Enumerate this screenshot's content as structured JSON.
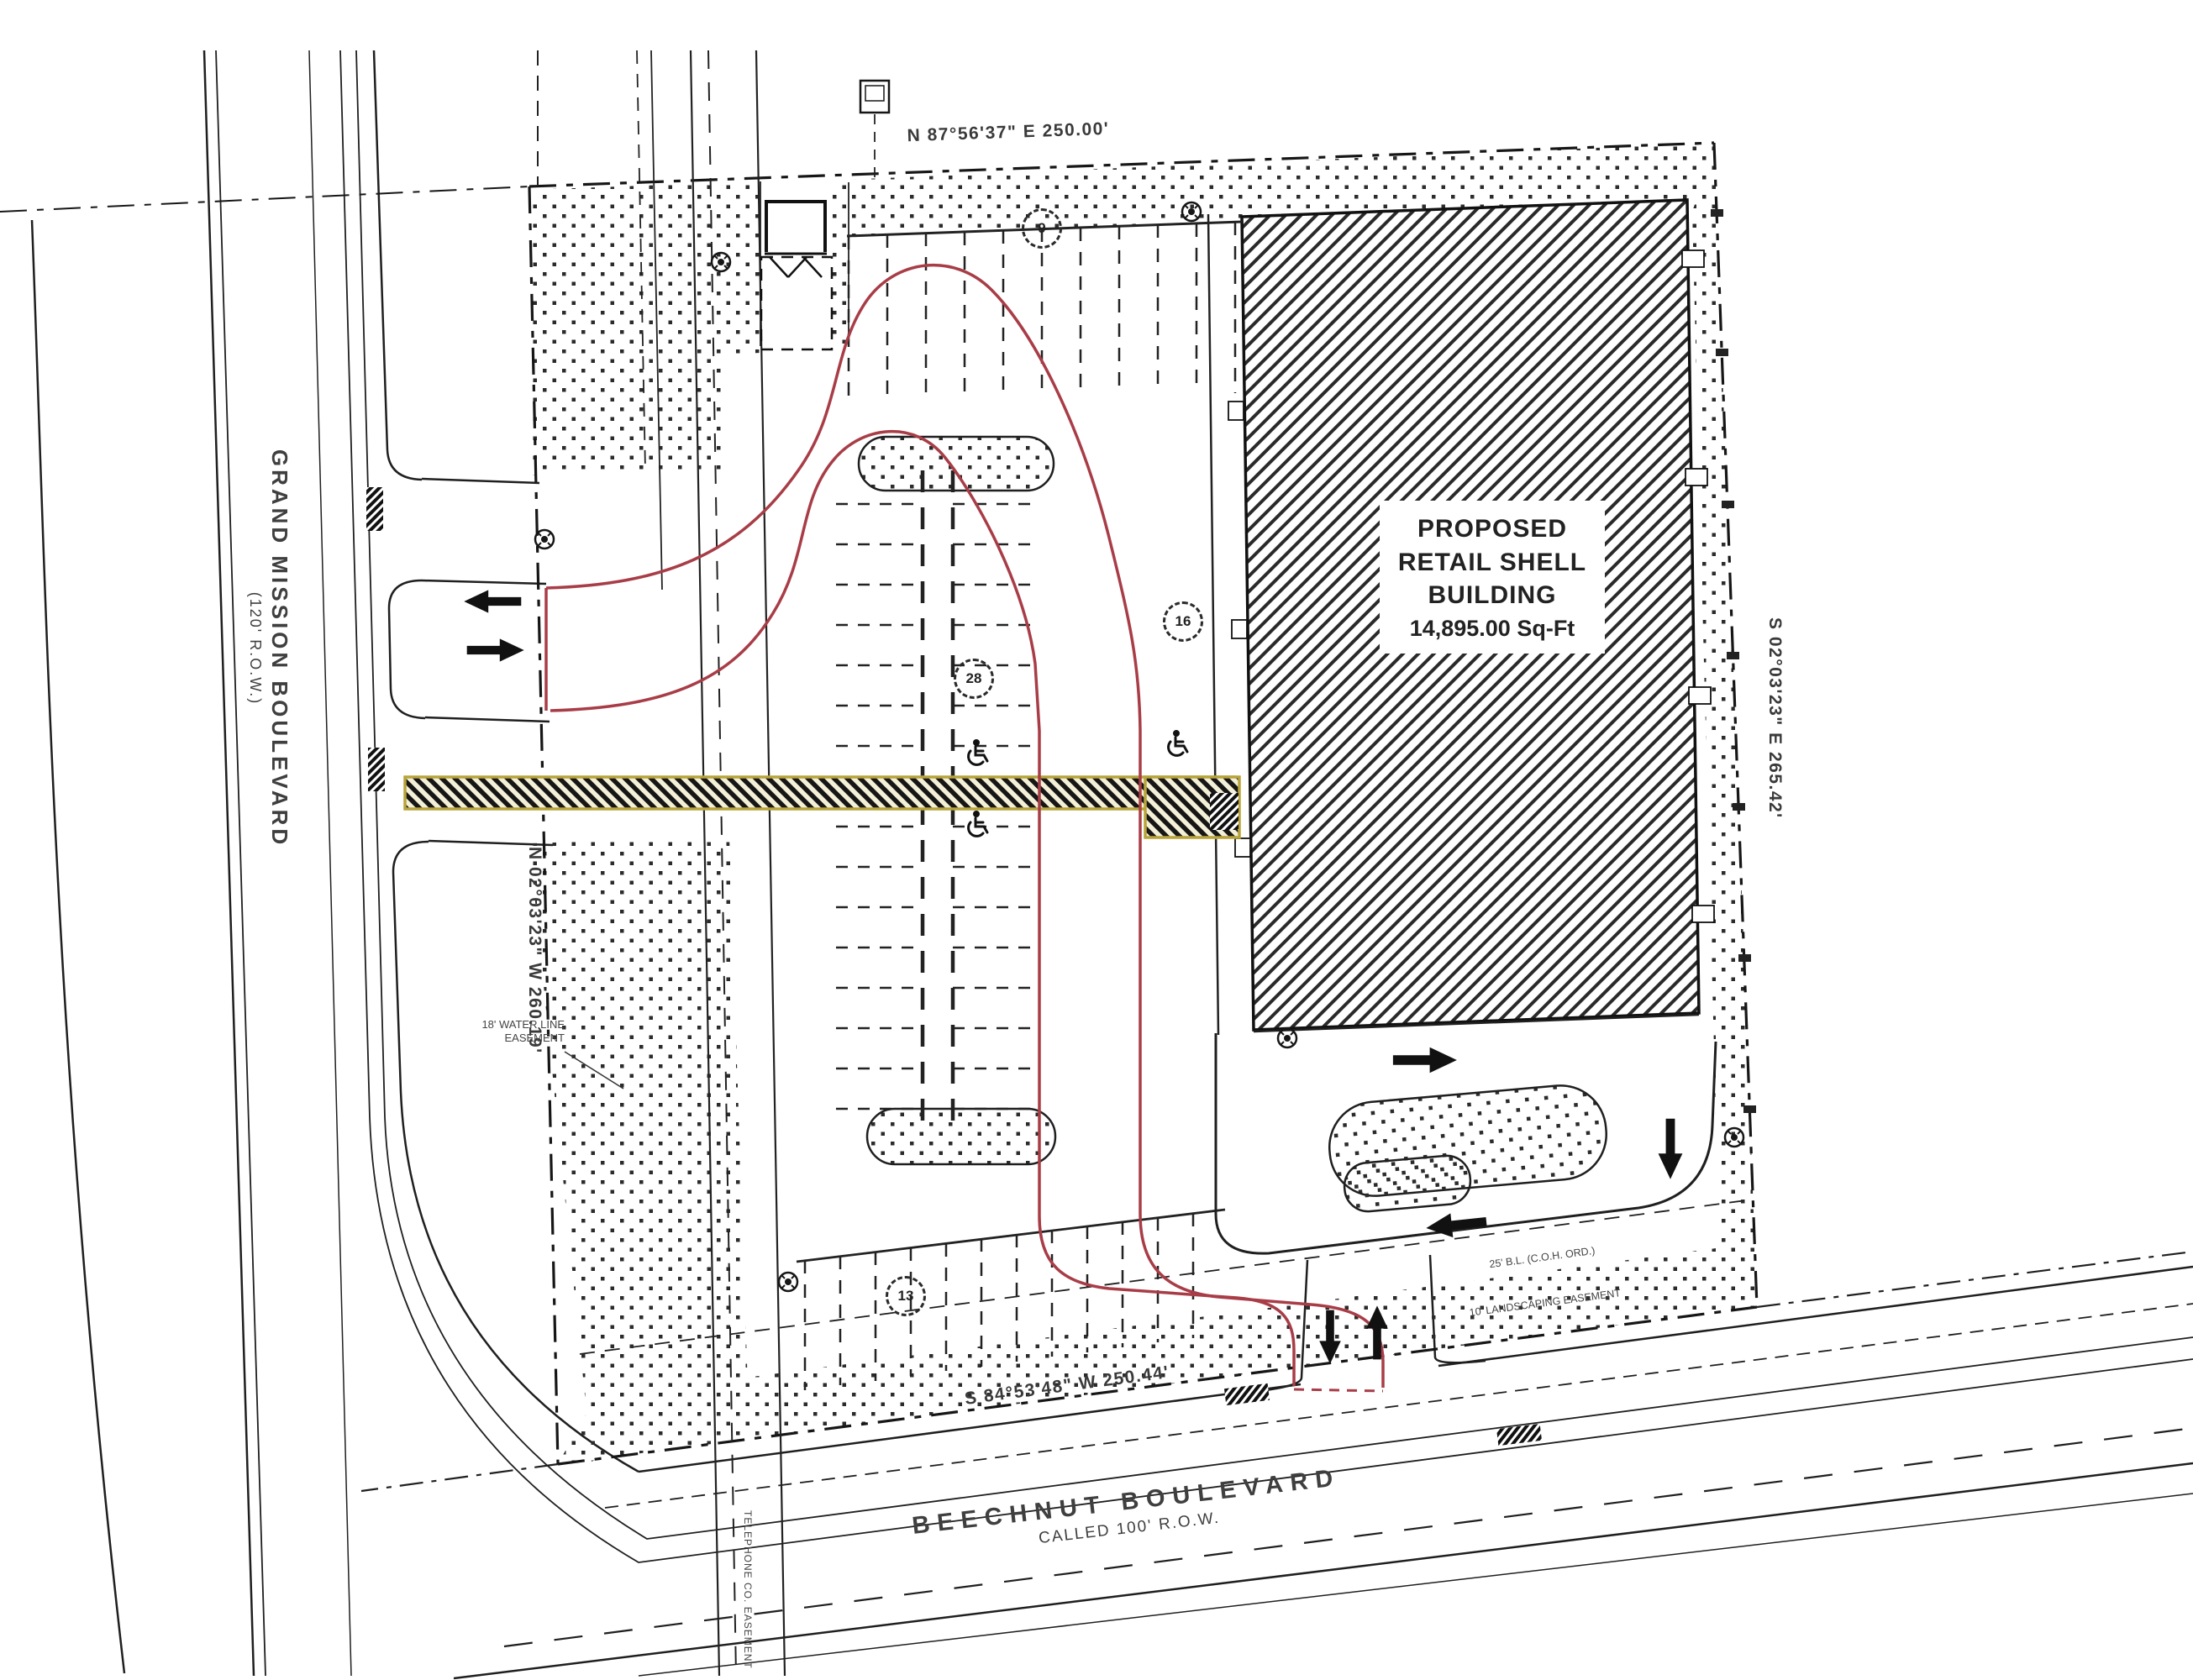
{
  "plan": {
    "streets": {
      "grand_mission": {
        "name": "GRAND MISSION BOULEVARD",
        "row": "(120' R.O.W.)"
      },
      "beechnut": {
        "name": "BEECHNUT BOULEVARD",
        "row": "CALLED 100' R.O.W."
      }
    },
    "boundaries": {
      "north": "N 87°56'37\" E   250.00'",
      "east": "S 02°03'23\" E   265.42'",
      "west": "N 02°03'23\" W   260.19'",
      "south": "S 84°53'48\" W   250.44'"
    },
    "building": {
      "line1": "PROPOSED",
      "line2": "RETAIL SHELL",
      "line3": "BUILDING",
      "line4": "14,895.00 Sq-Ft"
    },
    "easements": {
      "water_line1": "18' WATER LINE",
      "water_line2": "EASEMENT",
      "telephone": "TELEPHONE CO. EASEMENT",
      "building_line": "25' B.L. (C.O.H. ORD.)",
      "landscaping": "10' LANDSCAPING EASEMENT"
    },
    "parking_counts": {
      "north": "9",
      "center": "28",
      "east": "16",
      "south": "13"
    },
    "colors": {
      "fire_lane_red": "#a83d47",
      "easement_yellow": "#b8a43a",
      "line": "#1f1f1f"
    }
  }
}
